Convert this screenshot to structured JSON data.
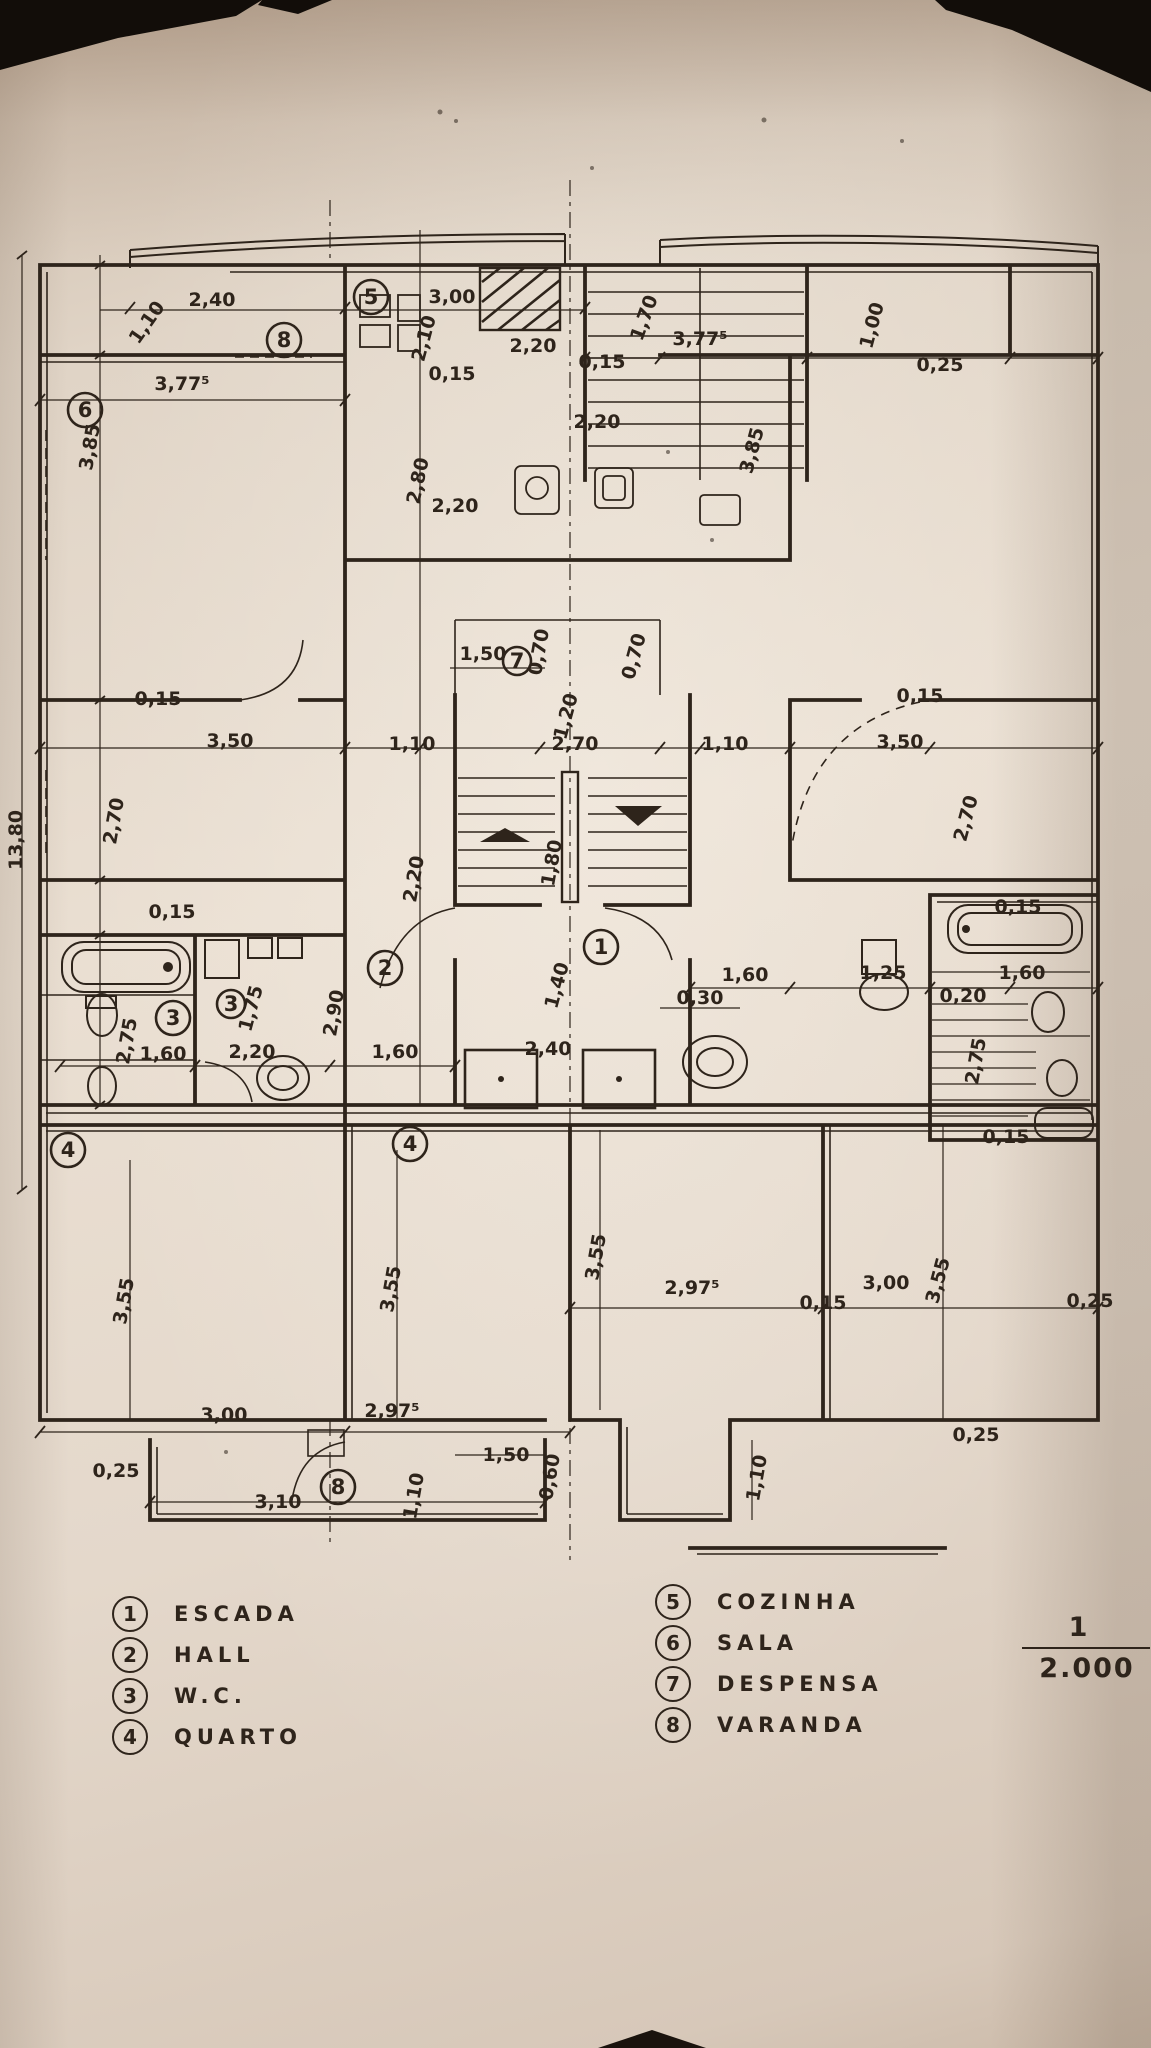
{
  "palette": {
    "background": "#16100b",
    "paper": "#e7dccf",
    "paper_shadow": "#c8b6a5",
    "ink": "#2e241b"
  },
  "legend": {
    "left": [
      {
        "n": "1",
        "label": "ESCADA"
      },
      {
        "n": "2",
        "label": "HALL"
      },
      {
        "n": "3",
        "label": "W.C."
      },
      {
        "n": "4",
        "label": "QUARTO"
      }
    ],
    "right": [
      {
        "n": "5",
        "label": "COZINHA"
      },
      {
        "n": "6",
        "label": "SALA"
      },
      {
        "n": "7",
        "label": "DESPENSA"
      },
      {
        "n": "8",
        "label": "VARANDA"
      }
    ]
  },
  "scale": {
    "numerator": "1",
    "denominator": "2.000"
  },
  "plan": {
    "room_markers": [
      {
        "n": "6",
        "x": 85,
        "y": 410
      },
      {
        "n": "8",
        "x": 284,
        "y": 340
      },
      {
        "n": "5",
        "x": 371,
        "y": 297
      },
      {
        "n": "7",
        "x": 517,
        "y": 661,
        "r": 14
      },
      {
        "n": "1",
        "x": 601,
        "y": 947
      },
      {
        "n": "2",
        "x": 385,
        "y": 968
      },
      {
        "n": "3",
        "x": 173,
        "y": 1018
      },
      {
        "n": "3",
        "x": 231,
        "y": 1004,
        "r": 14
      },
      {
        "n": "4",
        "x": 68,
        "y": 1150
      },
      {
        "n": "4",
        "x": 410,
        "y": 1144
      },
      {
        "n": "8",
        "x": 338,
        "y": 1487
      }
    ],
    "dimensions": [
      {
        "t": "2,40",
        "x": 212,
        "y": 306
      },
      {
        "t": "1,10",
        "x": 152,
        "y": 326,
        "r": -55
      },
      {
        "t": "3,00",
        "x": 452,
        "y": 303
      },
      {
        "t": "2,10",
        "x": 430,
        "y": 340,
        "r": -75
      },
      {
        "t": "0,15",
        "x": 452,
        "y": 380
      },
      {
        "t": "1,70",
        "x": 650,
        "y": 320,
        "r": -70
      },
      {
        "t": "1,00",
        "x": 878,
        "y": 327,
        "r": -75
      },
      {
        "t": "0,25",
        "x": 940,
        "y": 371
      },
      {
        "t": "2,20",
        "x": 533,
        "y": 352
      },
      {
        "t": "0,15",
        "x": 602,
        "y": 368
      },
      {
        "t": "3,77⁵",
        "x": 700,
        "y": 345
      },
      {
        "t": "3,77⁵",
        "x": 182,
        "y": 390,
        "s": 23
      },
      {
        "t": "3,85",
        "x": 96,
        "y": 448,
        "r": -80
      },
      {
        "t": "3,85",
        "x": 758,
        "y": 452,
        "r": -75
      },
      {
        "t": "2,80",
        "x": 424,
        "y": 482,
        "r": -78
      },
      {
        "t": "2,20",
        "x": 455,
        "y": 512
      },
      {
        "t": "2,20",
        "x": 597,
        "y": 428
      },
      {
        "t": "1,50",
        "x": 483,
        "y": 660
      },
      {
        "t": "0,70",
        "x": 545,
        "y": 653,
        "r": -80
      },
      {
        "t": "0,70",
        "x": 640,
        "y": 658,
        "r": -75
      },
      {
        "t": "1,20",
        "x": 572,
        "y": 718,
        "r": -75
      },
      {
        "t": "2,70",
        "x": 575,
        "y": 750
      },
      {
        "t": "1,10",
        "x": 412,
        "y": 750
      },
      {
        "t": "3,50",
        "x": 230,
        "y": 747
      },
      {
        "t": "0,15",
        "x": 158,
        "y": 705
      },
      {
        "t": "2,70",
        "x": 120,
        "y": 822,
        "r": -80
      },
      {
        "t": "1,10",
        "x": 725,
        "y": 750
      },
      {
        "t": "3,50",
        "x": 900,
        "y": 748
      },
      {
        "t": "0,15",
        "x": 920,
        "y": 702
      },
      {
        "t": "2,70",
        "x": 972,
        "y": 820,
        "r": -75
      },
      {
        "t": "2,20",
        "x": 420,
        "y": 880,
        "r": -80
      },
      {
        "t": "1,80",
        "x": 558,
        "y": 864,
        "r": -80
      },
      {
        "t": "1,40",
        "x": 563,
        "y": 987,
        "r": -75
      },
      {
        "t": "2,90",
        "x": 340,
        "y": 1014,
        "r": -80
      },
      {
        "t": "0,15",
        "x": 172,
        "y": 918
      },
      {
        "t": "2,75",
        "x": 133,
        "y": 1042,
        "r": -80
      },
      {
        "t": "1,75",
        "x": 257,
        "y": 1010,
        "r": -75
      },
      {
        "t": "1,60",
        "x": 163,
        "y": 1060
      },
      {
        "t": "2,20",
        "x": 252,
        "y": 1058
      },
      {
        "t": "1,60",
        "x": 395,
        "y": 1058
      },
      {
        "t": "2,40",
        "x": 548,
        "y": 1055
      },
      {
        "t": "0,30",
        "x": 700,
        "y": 1004
      },
      {
        "t": "1,60",
        "x": 745,
        "y": 981
      },
      {
        "t": "1,25",
        "x": 883,
        "y": 979
      },
      {
        "t": "1,60",
        "x": 1022,
        "y": 979
      },
      {
        "t": "0,20",
        "x": 963,
        "y": 1002
      },
      {
        "t": "2,75",
        "x": 982,
        "y": 1062,
        "r": -80
      },
      {
        "t": "0,15",
        "x": 1018,
        "y": 913
      },
      {
        "t": "0,15",
        "x": 1006,
        "y": 1143
      },
      {
        "t": "3,55",
        "x": 130,
        "y": 1302,
        "r": -80
      },
      {
        "t": "3,55",
        "x": 397,
        "y": 1290,
        "r": -80
      },
      {
        "t": "3,55",
        "x": 602,
        "y": 1258,
        "r": -80
      },
      {
        "t": "2,97⁵",
        "x": 692,
        "y": 1294
      },
      {
        "t": "3,00",
        "x": 886,
        "y": 1289
      },
      {
        "t": "0,15",
        "x": 823,
        "y": 1309
      },
      {
        "t": "3,55",
        "x": 944,
        "y": 1282,
        "r": -75
      },
      {
        "t": "0,25",
        "x": 1090,
        "y": 1307
      },
      {
        "t": "3,00",
        "x": 224,
        "y": 1421
      },
      {
        "t": "2,97⁵",
        "x": 392,
        "y": 1417
      },
      {
        "t": "0,25",
        "x": 116,
        "y": 1477
      },
      {
        "t": "3,10",
        "x": 278,
        "y": 1508
      },
      {
        "t": "1,10",
        "x": 420,
        "y": 1497,
        "r": -80
      },
      {
        "t": "1,50",
        "x": 506,
        "y": 1461
      },
      {
        "t": "0,60",
        "x": 556,
        "y": 1478,
        "r": -80
      },
      {
        "t": "1,10",
        "x": 763,
        "y": 1479,
        "r": -80
      },
      {
        "t": "0,25",
        "x": 976,
        "y": 1441
      },
      {
        "t": "13,80",
        "x": 22,
        "y": 840,
        "r": -90,
        "s": 22
      }
    ]
  }
}
